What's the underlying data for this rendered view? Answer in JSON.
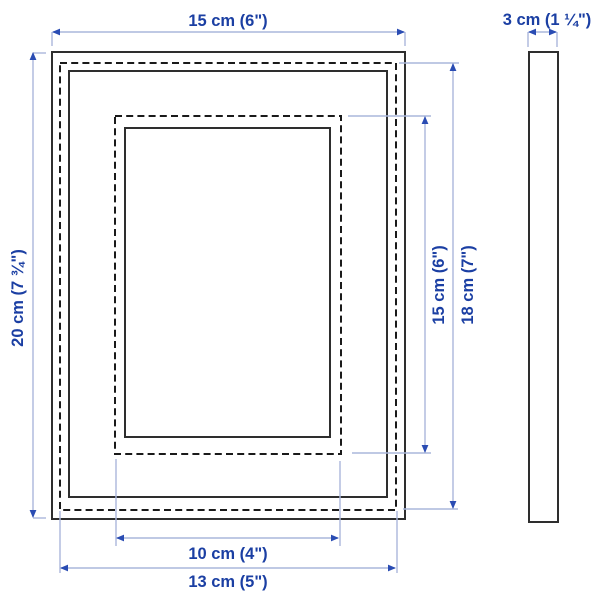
{
  "diagram": {
    "front_view": {
      "frame_width": "15 cm (6\")",
      "frame_height": "20 cm (7 ¾\")",
      "picture_width": "13 cm (5\")",
      "picture_height": "18 cm (7\")",
      "matted_picture_width": "10 cm (4\")",
      "matted_picture_height": "15 cm (6\")"
    },
    "side_view": {
      "depth": "3 cm (1 ¼\")"
    }
  },
  "colors": {
    "frame_line": "#2e2e2e",
    "dashed_line": "#1a1a1a",
    "dim_line": "#aab7dc",
    "arrow": "#2a4cb3",
    "label_text": "#1b3fa3",
    "background": "#ffffff"
  }
}
